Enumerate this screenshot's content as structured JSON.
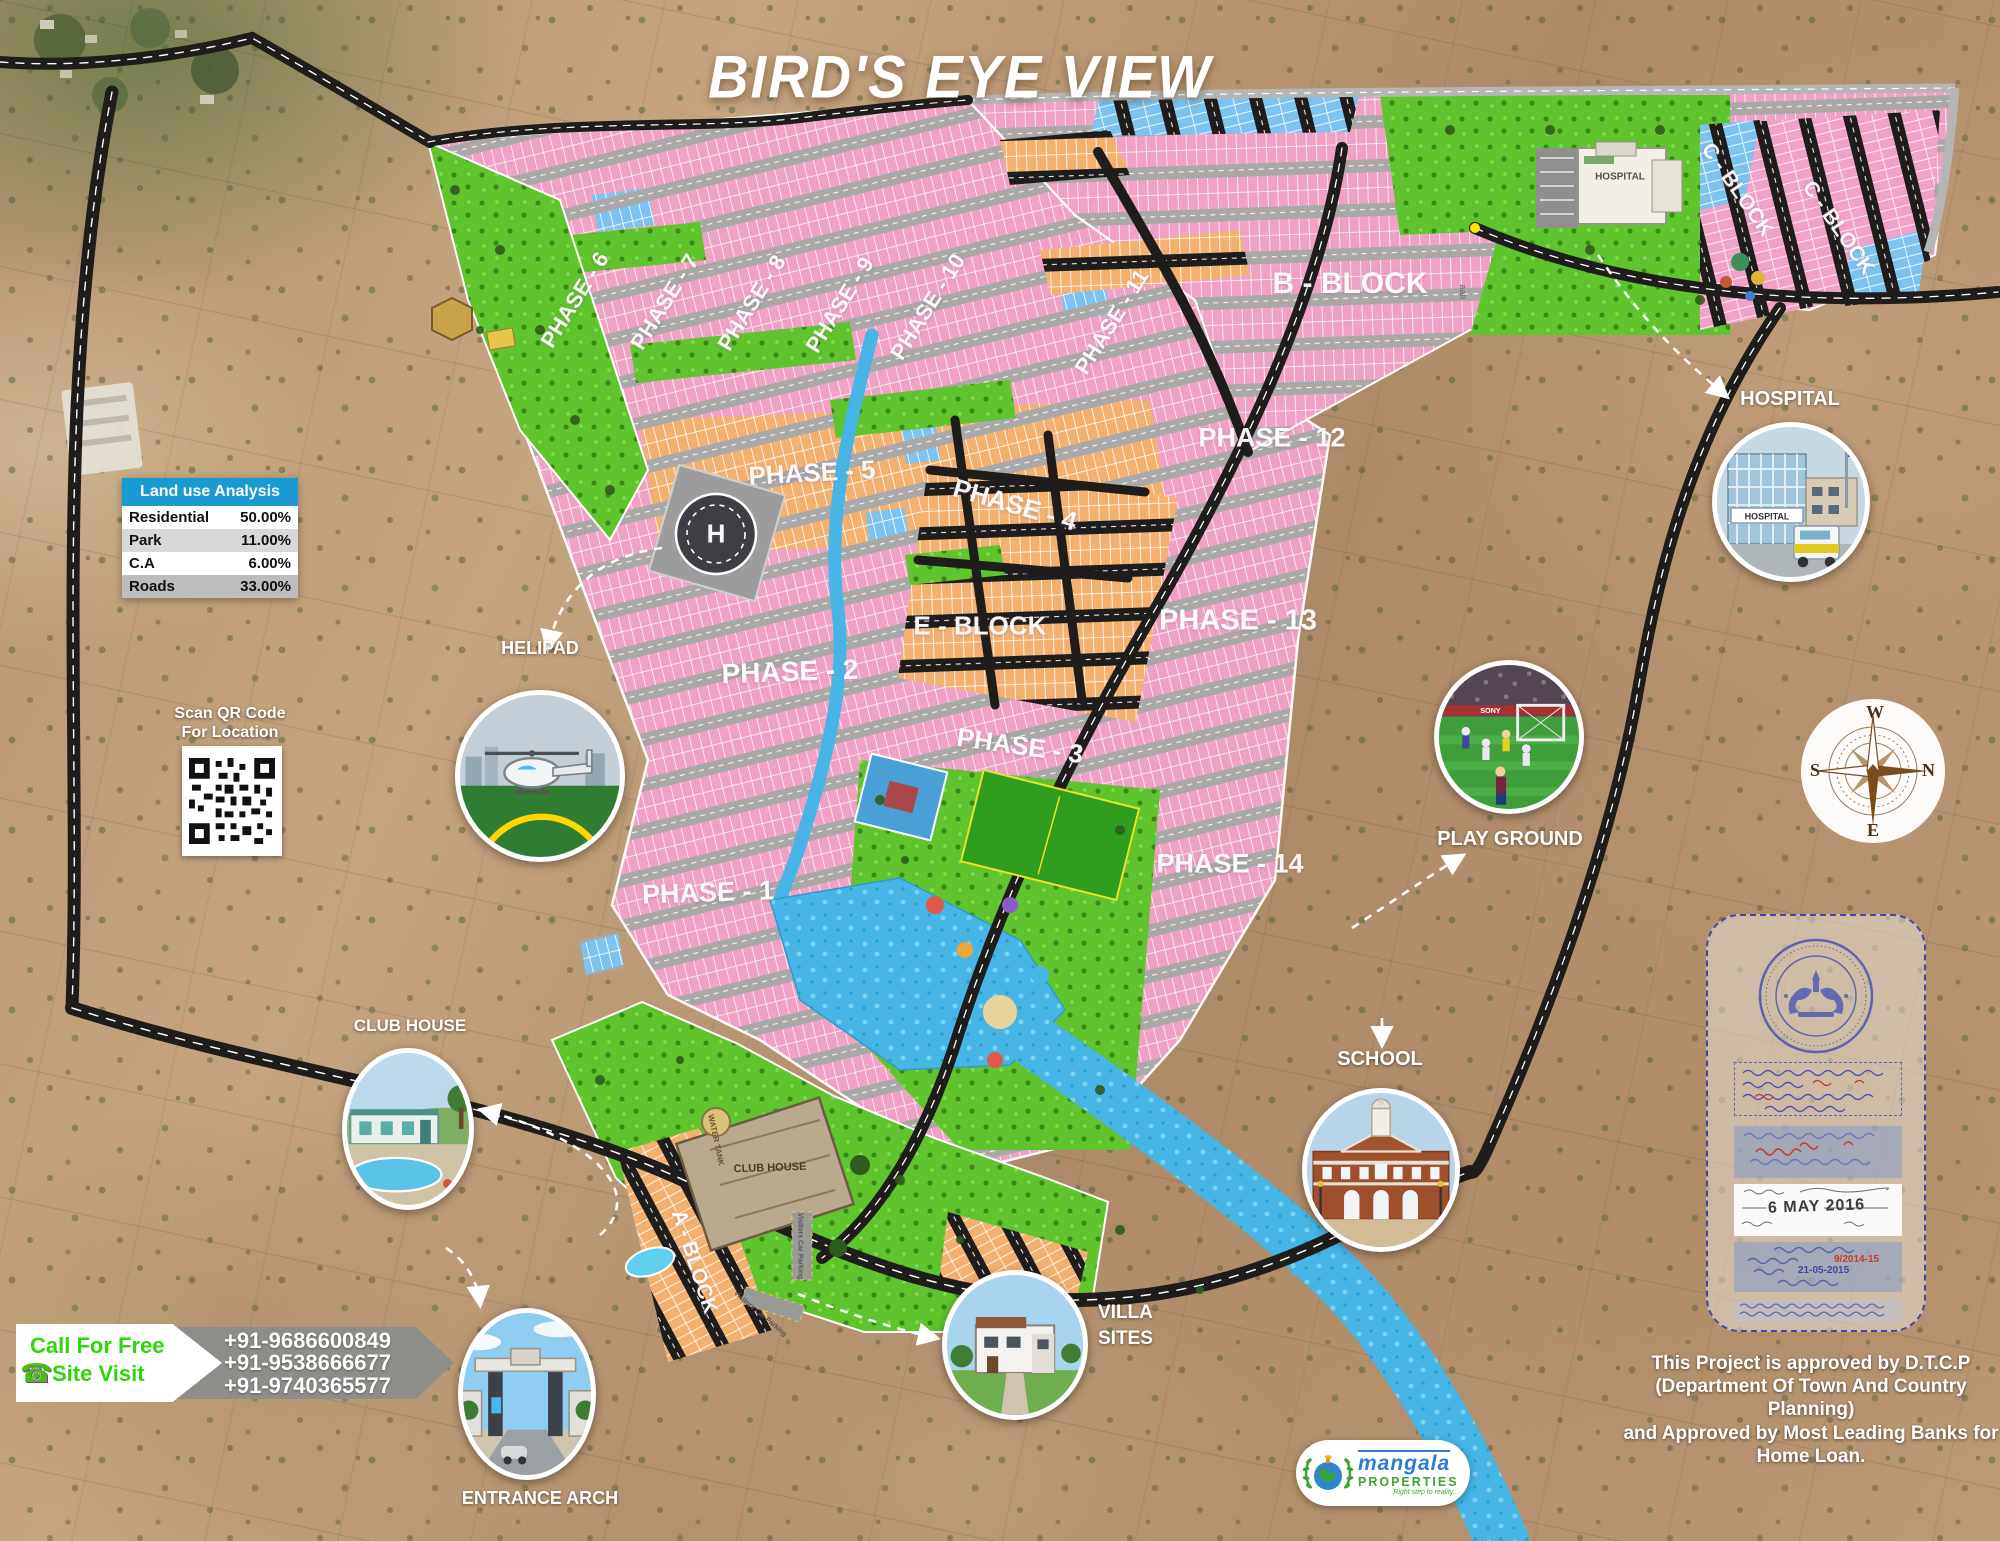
{
  "title": "BIRD'S EYE VIEW",
  "land_use": {
    "header": "Land use Analysis",
    "rows": [
      {
        "name": "Residential",
        "value": "50.00%"
      },
      {
        "name": "Park",
        "value": "11.00%"
      },
      {
        "name": "C.A",
        "value": "6.00%"
      },
      {
        "name": "Roads",
        "value": "33.00%"
      }
    ]
  },
  "qr": {
    "line1": "Scan QR Code",
    "line2": "For Location"
  },
  "contact": {
    "line1": "Call For Free",
    "line2": "Site Visit",
    "phones": [
      "+91-9686600849",
      "+91-9538666677",
      "+91-9740365577"
    ]
  },
  "callouts": {
    "helipad": "HELIPAD",
    "club_house": "CLUB HOUSE",
    "entrance_arch": "ENTRANCE ARCH",
    "villa_line1": "VILLA",
    "villa_line2": "SITES",
    "hospital": "HOSPITAL",
    "hospital_sign": "HOSPITAL",
    "play_ground": "PLAY GROUND",
    "playground_ad": "SONY",
    "school": "SCHOOL"
  },
  "map_labels": {
    "phase_1": "PHASE - 1",
    "phase_2": "PHASE - 2",
    "phase_3": "PHASE - 3",
    "phase_4": "PHASE - 4",
    "phase_5": "PHASE - 5",
    "phase_6": "PHASE - 6",
    "phase_7": "PHASE - 7",
    "phase_8": "PHASE - 8",
    "phase_9": "PHASE - 9",
    "phase_10": "PHASE - 10",
    "phase_11": "PHASE - 11",
    "phase_12": "PHASE - 12",
    "phase_13": "PHASE - 13",
    "phase_14": "PHASE - 14",
    "a_block": "A - BLOCK",
    "b_block": "B - BLOCK",
    "c_block_1": "C - BLOCK",
    "c_block_2": "C - BLOCK",
    "e_block": "E - BLOCK",
    "hospital_building": "HOSPITAL",
    "club_house_building": "CLUB HOUSE",
    "water_tank": "WATER TANK",
    "visitors_parking_1": "Visitors Car Parking",
    "visitors_parking_2": "Visitors Car Parking",
    "road_name": "aali",
    "helipad_h": "H"
  },
  "compass": {
    "n": "N",
    "s": "S",
    "e": "E",
    "w": "W"
  },
  "stamp": {
    "date": "6 MAY 2016",
    "ref_no": "9/2014-15",
    "ref_date": "21-05-2015"
  },
  "approval": {
    "line1": "This Project is approved by D.T.C.P",
    "line2": "(Department Of Town And Country Planning)",
    "line3": "and Approved by Most Leading Banks for",
    "line4": "Home Loan."
  },
  "logo": {
    "name": "mangala",
    "word": "PROPERTIES",
    "tagline": "Right step to reality..."
  },
  "colors": {
    "accent_blue": "#1b9ad2",
    "plot_pink": "#f2a2c8",
    "plot_orange": "#f3b06e",
    "plot_blue": "#7cc3ef",
    "park_green": "#5fc42d",
    "water_blue": "#47b5e6",
    "contact_green": "#2ed60a"
  }
}
